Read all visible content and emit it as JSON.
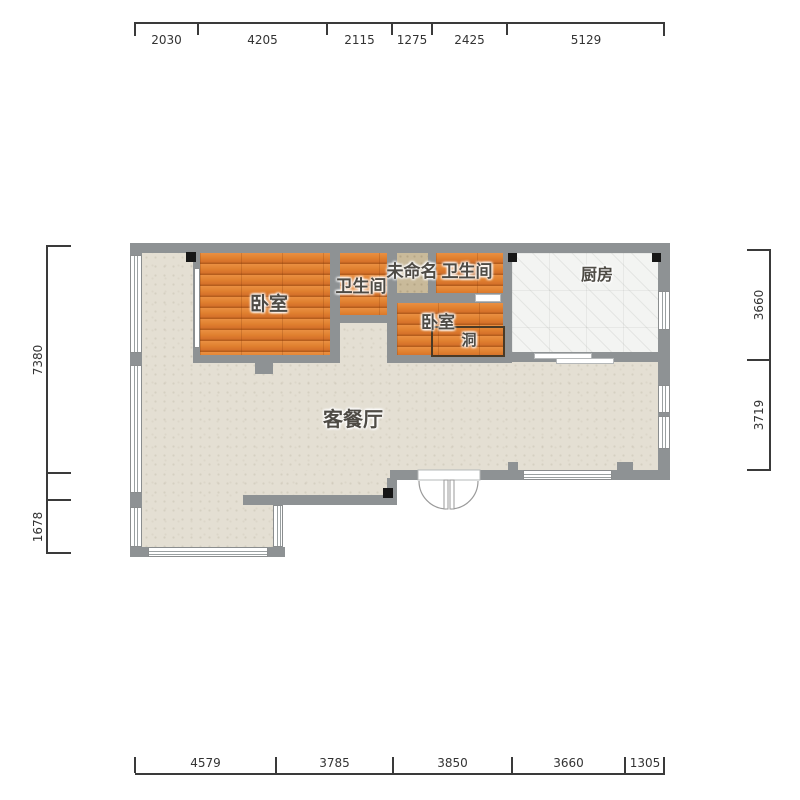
{
  "title": "floor-plan",
  "dimensions": {
    "top": [
      "2030",
      "4205",
      "2115",
      "1275",
      "2425",
      "5129"
    ],
    "bottom": [
      "4579",
      "3785",
      "3850",
      "3660",
      "1305"
    ],
    "left": [
      "7380",
      "1678"
    ],
    "right": [
      "3660",
      "3719"
    ]
  },
  "labels": {
    "bedroom1": "卧室",
    "bathroom1": "卫生间",
    "unnamed": "未命名",
    "bathroom2": "卫生间",
    "kitchen": "厨房",
    "bedroom2": "卧室",
    "hole": "洞",
    "living_dining": "客餐厅"
  },
  "colors": {
    "wall": "#8e9294",
    "column": "#161616",
    "floor_living": "#e4dfd3",
    "floor_wood": "#df7e31",
    "floor_kitchen": "#f3f4f2",
    "floor_unnamed": "#c9ba9a",
    "dimension_text": "#333333",
    "room_label_text": "#4e4b45"
  }
}
